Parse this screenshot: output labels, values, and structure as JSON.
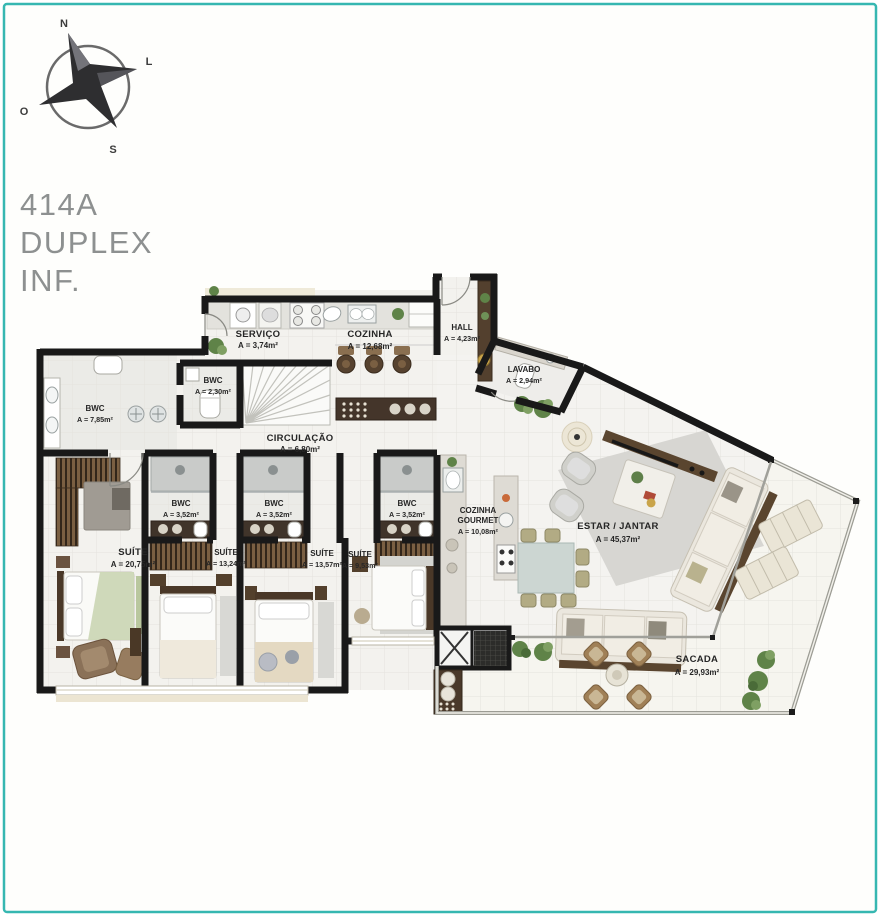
{
  "page": {
    "frame_color": "#36b7b1",
    "wall_color": "#191919",
    "wood_color": "#5a452f",
    "plant_color": "#5f8348"
  },
  "compass": {
    "n": "N",
    "l": "L",
    "s": "S",
    "o": "O"
  },
  "title": {
    "line1": "414A",
    "line2": "DUPLEX",
    "line3": "INF."
  },
  "rooms": {
    "servico": {
      "name": "SERVIÇO",
      "area": "A = 3,74m²"
    },
    "cozinha": {
      "name": "COZINHA",
      "area": "A = 12,68m²"
    },
    "hall": {
      "name": "HALL",
      "area": "A = 4,23m²"
    },
    "lavabo": {
      "name": "LAVABO",
      "area": "A = 2,94m²"
    },
    "bwc_social": {
      "name": "BWC",
      "area": "A = 7,85m²"
    },
    "bwc_servico": {
      "name": "BWC",
      "area": "A = 2,30m²"
    },
    "circulacao": {
      "name": "CIRCULAÇÃO",
      "area": "A = 6,80m²"
    },
    "bwc_suite2": {
      "name": "BWC",
      "area": "A = 3,52m²"
    },
    "bwc_suite3": {
      "name": "BWC",
      "area": "A = 3,52m²"
    },
    "bwc_suite4": {
      "name": "BWC",
      "area": "A = 3,52m²"
    },
    "suite_master": {
      "name": "SUÍTE",
      "area": "A = 20,75m²"
    },
    "suite_2": {
      "name": "SUÍTE",
      "area": "A = 13,24m²"
    },
    "suite_3": {
      "name": "SUÍTE",
      "area": "A = 13,57m²"
    },
    "suite_4": {
      "name": "SUÍTE",
      "area": "A = 9,53m²"
    },
    "cozinha_gourmet": {
      "name_line1": "COZINHA",
      "name_line2": "GOURMET",
      "area": "A = 10,08m²"
    },
    "estar_jantar": {
      "name": "ESTAR / JANTAR",
      "area": "A = 45,37m²"
    },
    "sacada": {
      "name": "SACADA",
      "area": "A = 29,93m²"
    }
  }
}
